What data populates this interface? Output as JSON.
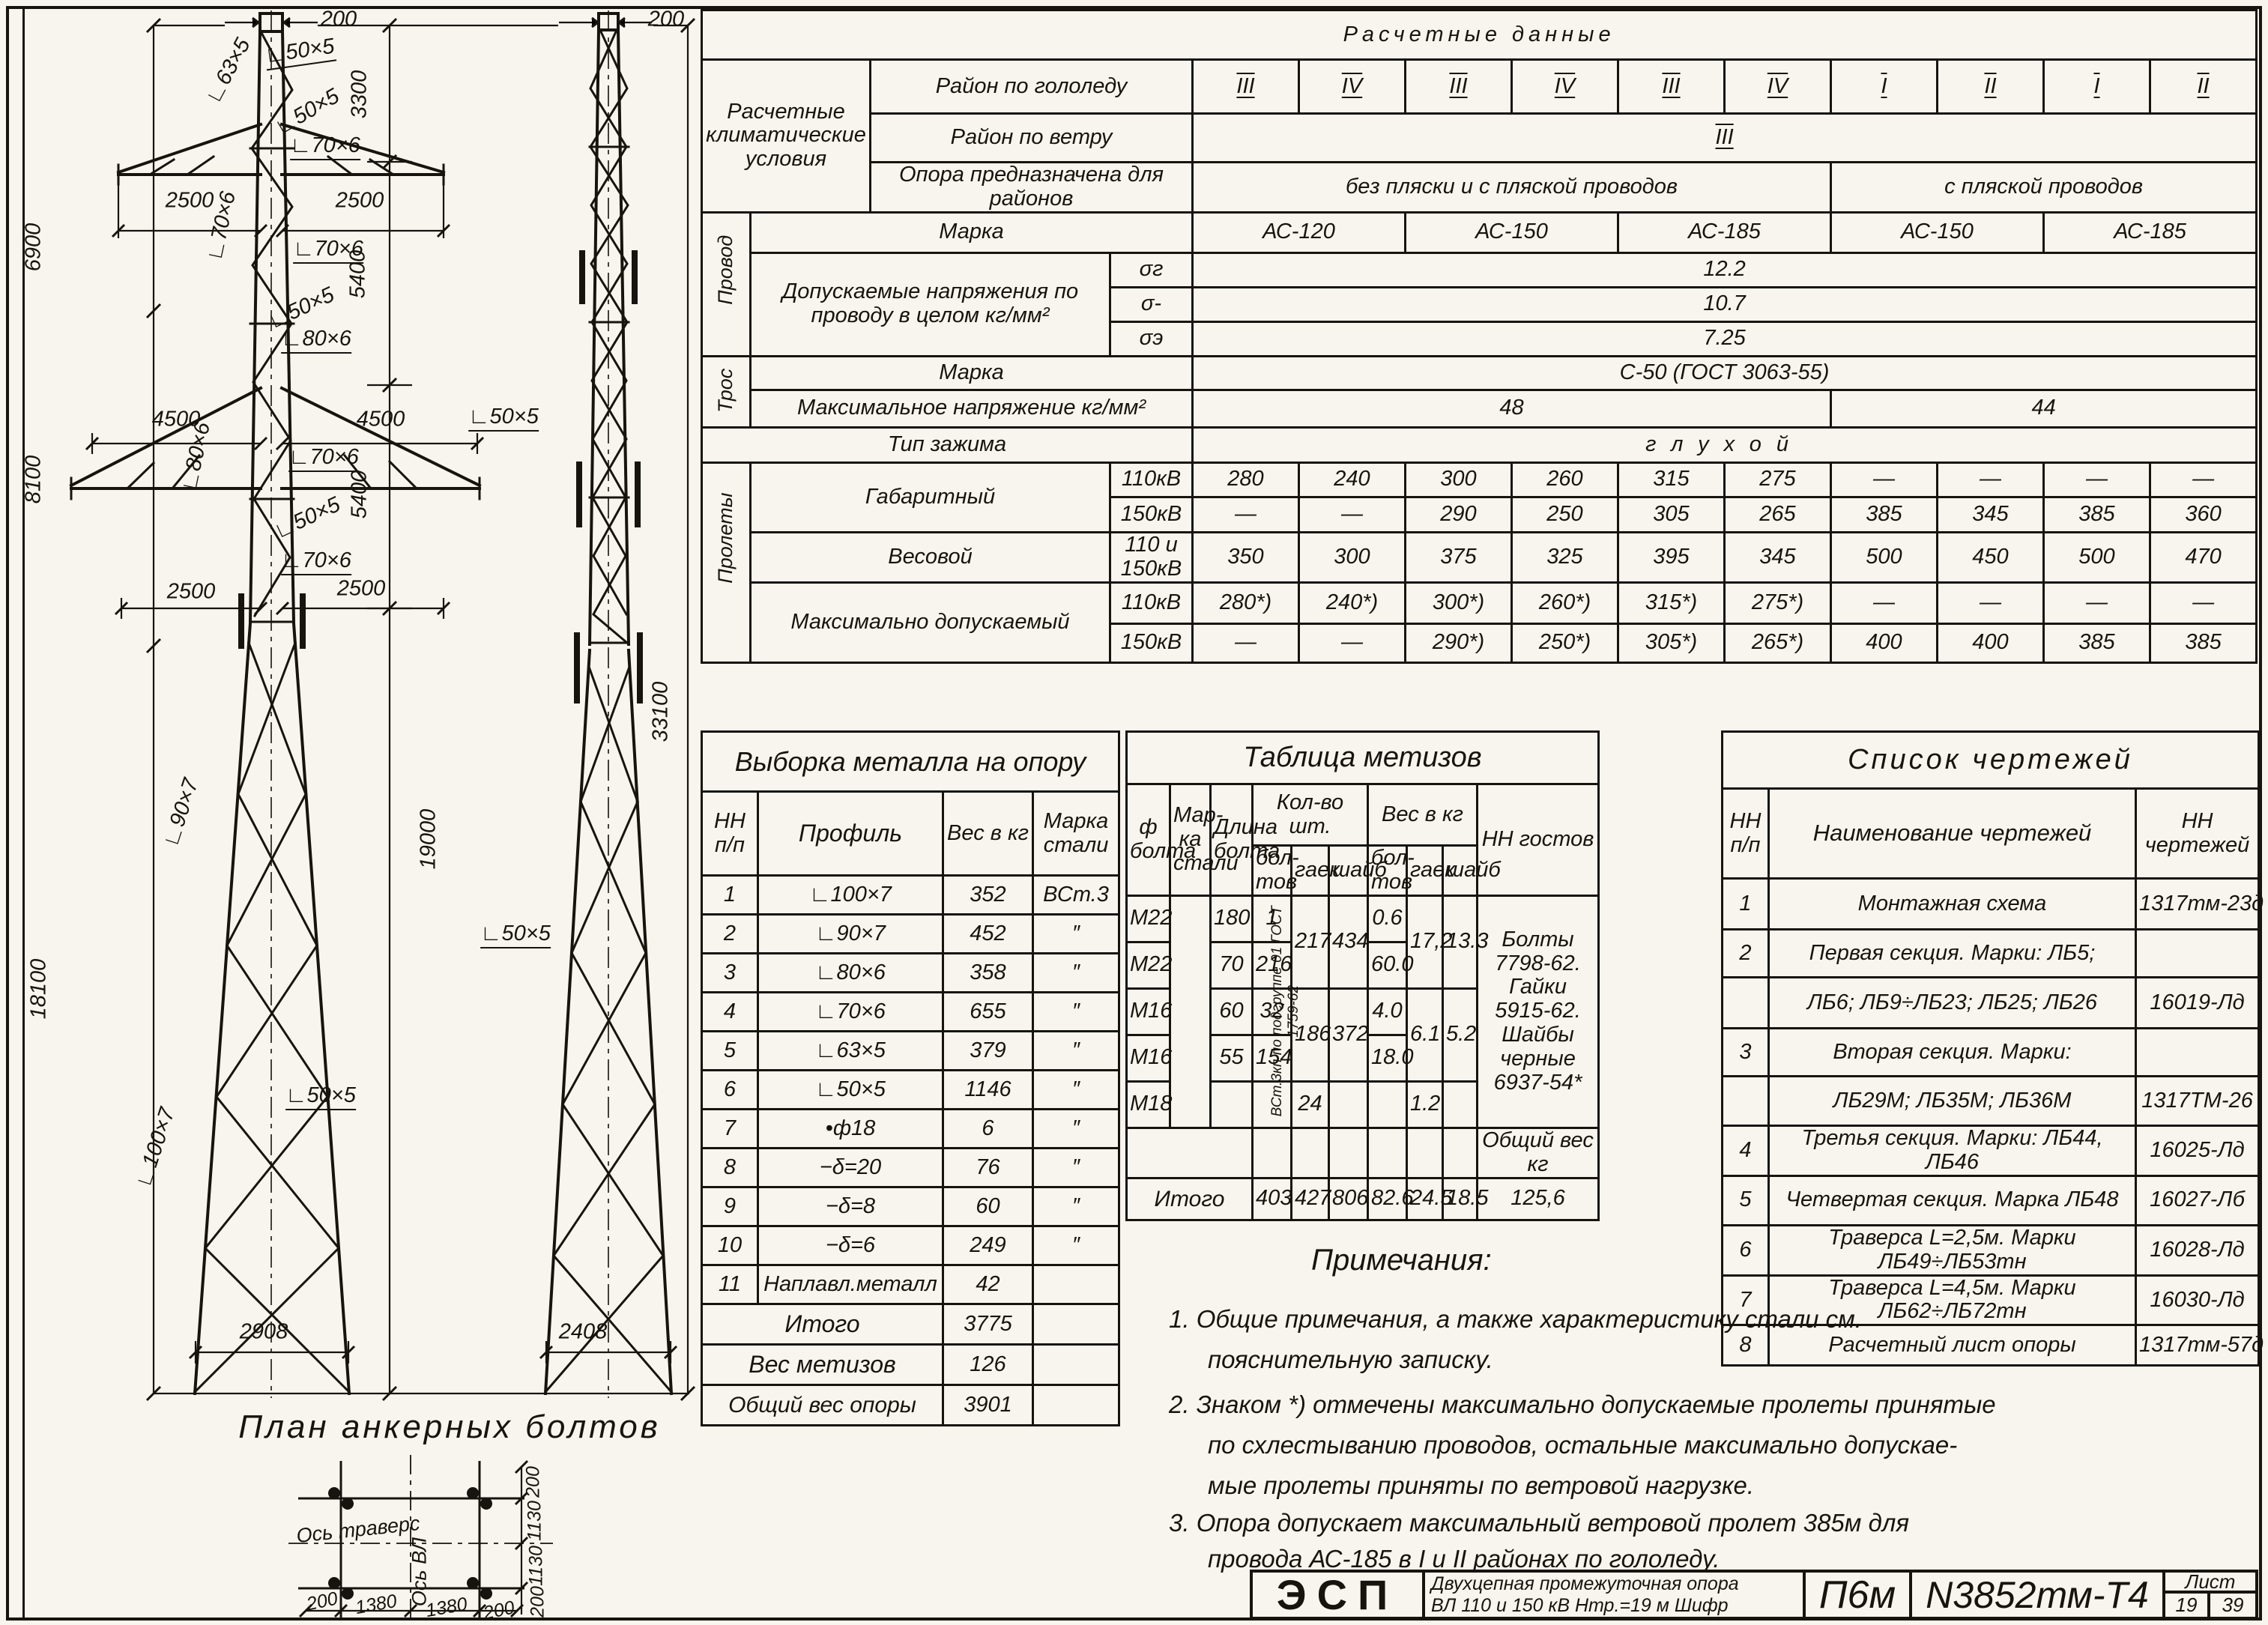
{
  "sheet": {
    "calc": {
      "title": "Расчетные  данные",
      "left_header": "Расчетные климатические условия",
      "ice_label": "Район по гололеду",
      "ice": [
        "III",
        "IV",
        "III",
        "IV",
        "III",
        "IV",
        "I",
        "II",
        "I",
        "II"
      ],
      "wind_label": "Район по ветру",
      "wind": "III",
      "purpose_label": "Опора предназначена для районов",
      "purpose_a": "без пляски и с пляской проводов",
      "purpose_b": "с пляской проводов",
      "wire_side": "Провод",
      "wire_marka_label": "Марка",
      "wire_marka": [
        "АС-120",
        "АС-150",
        "АС-185",
        "АС-150",
        "АС-185"
      ],
      "stress_label": "Допускаемые напряжения по проводу в целом кг/мм²",
      "s1_label": "σг",
      "s1": "12.2",
      "s2_label": "σ-",
      "s2": "10.7",
      "s3_label": "σэ",
      "s3": "7.25",
      "cable_side": "Трос",
      "cable_marka_label": "Марка",
      "cable_marka": "С-50 (ГОСТ 3063-55)",
      "tension_label": "Максимальное напряжение кг/мм²",
      "tension_a": "48",
      "tension_b": "44",
      "clamp_label": "Тип зажима",
      "clamp": "глухой",
      "spans_side": "Пролеты",
      "gabarit_label": "Габаритный",
      "kv110": "110кВ",
      "kv150": "150кВ",
      "kv_both": "110 и 150кВ",
      "g110": [
        "280",
        "240",
        "300",
        "260",
        "315",
        "275",
        "—",
        "—",
        "—",
        "—"
      ],
      "g150": [
        "—",
        "—",
        "290",
        "250",
        "305",
        "265",
        "385",
        "345",
        "385",
        "360"
      ],
      "weight_label": "Весовой",
      "wv": [
        "350",
        "300",
        "375",
        "325",
        "395",
        "345",
        "500",
        "450",
        "500",
        "470"
      ],
      "max_label": "Максимально допускаемый",
      "m110": [
        "280*)",
        "240*)",
        "300*)",
        "260*)",
        "315*)",
        "275*)",
        "—",
        "—",
        "—",
        "—"
      ],
      "m150": [
        "—",
        "—",
        "290*)",
        "250*)",
        "305*)",
        "265*)",
        "400",
        "400",
        "385",
        "385"
      ]
    },
    "metal": {
      "title": "Выборка металла на опору",
      "h_nn": "НН п/п",
      "h_profile": "Профиль",
      "h_weight": "Вес в кг",
      "h_steel": "Марка стали",
      "rows": [
        [
          "1",
          "∟100×7",
          "352",
          "ВСт.3"
        ],
        [
          "2",
          "∟90×7",
          "452",
          "″"
        ],
        [
          "3",
          "∟80×6",
          "358",
          "″"
        ],
        [
          "4",
          "∟70×6",
          "655",
          "″"
        ],
        [
          "5",
          "∟63×5",
          "379",
          "″"
        ],
        [
          "6",
          "∟50×5",
          "1146",
          "″"
        ],
        [
          "7",
          "•ф18",
          "6",
          "″"
        ],
        [
          "8",
          "−δ=20",
          "76",
          "″"
        ],
        [
          "9",
          "−δ=8",
          "60",
          "″"
        ],
        [
          "10",
          "−δ=6",
          "249",
          "″"
        ],
        [
          "11",
          "Наплавл.металл",
          "42",
          ""
        ]
      ],
      "total_label": "Итого",
      "total": "3775",
      "hw_label": "Вес метизов",
      "hw": "126",
      "grand_label": "Общий вес опоры",
      "grand": "3901"
    },
    "hardware": {
      "title": "Таблица метизов",
      "h_dia": "ф болта",
      "h_steel": "Мар-ка стали",
      "h_len": "Длина болта",
      "h_qty": "Кол-во шт.",
      "h_wt": "Вес в кг",
      "h_gost": "НН гостов",
      "h_bolts": "бол-тов",
      "h_nuts": "гаек",
      "h_wash": "шайб",
      "steel_note": "ВСт.3кп по подгруппе 01 ГОСТ 1759-62",
      "gost_note": "Болты 7798-62. Гайки 5915-62. Шайбы черные 6937-54*",
      "total_wt_label": "Общий вес кг",
      "r1": [
        "М22",
        "180",
        "1",
        "0.6"
      ],
      "r2": [
        "М22",
        "70",
        "216",
        "60.0"
      ],
      "r3": [
        "М16",
        "60",
        "32",
        "4.0"
      ],
      "r4": [
        "М16",
        "55",
        "154",
        "18.0"
      ],
      "r5": [
        "М18",
        "",
        "24",
        "1.2"
      ],
      "qn12": "217",
      "qw12": "434",
      "wn12": "17,2",
      "ww12": "13.3",
      "qn34": "186",
      "qw34": "372",
      "wn34": "6.1",
      "ww34": "5.2",
      "total_label": "Итого",
      "totals": [
        "403",
        "427",
        "806",
        "82.6",
        "24.5",
        "18.5",
        "125,6"
      ]
    },
    "list": {
      "title": "Список чертежей",
      "h_nn": "НН п/п",
      "h_name": "Наименование чертежей",
      "h_num": "НН чертежей",
      "rows": [
        [
          "1",
          "Монтажная схема",
          "1317тм-23д"
        ],
        [
          "2",
          "Первая секция. Марки: ЛБ5;",
          ""
        ],
        [
          "",
          "ЛБ6; ЛБ9÷ЛБ23; ЛБ25; ЛБ26",
          "16019-Лд"
        ],
        [
          "3",
          "Вторая секция. Марки:",
          ""
        ],
        [
          "",
          "ЛБ29М; ЛБ35М; ЛБ36М",
          "1317ТМ-26"
        ],
        [
          "4",
          "Третья секция. Марки: ЛБ44, ЛБ46",
          "16025-Лд"
        ],
        [
          "5",
          "Четвертая секция. Марка ЛБ48",
          "16027-Лб"
        ],
        [
          "6",
          "Траверса L=2,5м. Марки ЛБ49÷ЛБ53тн",
          "16028-Лд"
        ],
        [
          "7",
          "Траверса L=4,5м. Марки ЛБ62÷ЛБ72тн",
          "16030-Лд"
        ],
        [
          "8",
          "Расчетный лист опоры",
          "1317тм-57д"
        ]
      ]
    },
    "notes": {
      "title": "Примечания:",
      "n1a": "1. Общие примечания, а также характеристику стали см.",
      "n1b": "пояснительную записку.",
      "n2a": "2. Знаком *) отмечены максимально допускаемые пролеты принятые",
      "n2b": "по схлестыванию проводов, остальные максимально допускае-",
      "n2c": "мые пролеты приняты  по ветровой нагрузке.",
      "n3a": "3. Опора допускает максимальный ветровой пролет 385м для",
      "n3b": "провода АС-185 в I и II районах по гололеду."
    },
    "tb": {
      "org": "ЭСП",
      "desc1": "Двухцепная промежуточная опора",
      "desc2": "ВЛ 110 и 150 кВ  Нтр.=19 м        Шифр",
      "type": "П6м",
      "num": "N3852тм-Т4",
      "sheet_label": "Лист",
      "sheet_no": "19",
      "sheet_total": "39"
    },
    "dwg": {
      "front_top": "200",
      "side_top": "200",
      "h1": "6900",
      "h2": "8100",
      "h3": "18100",
      "v1": "3300",
      "v2": "5400",
      "v3": "5400",
      "v4": "19000",
      "vtotal": "33100",
      "a1l": "2500",
      "a1r": "2500",
      "a2l": "4500",
      "a2r": "4500",
      "a3l": "2500",
      "a3r": "2500",
      "base_front": "2908",
      "base_side": "2408",
      "m1": "∟63×5",
      "m2": "∟50×5",
      "m3": "∟50×5",
      "m4": "∟70×6",
      "m5": "∟70×6",
      "m6": "∟70×6",
      "m7": "∟50×5",
      "m8": "∟80×6",
      "m9": "∟80×6",
      "m10": "∟70×6",
      "m11": "∟50×5",
      "m12": "∟70×6",
      "m13": "∟90×7",
      "m14": "∟50×5",
      "m15": "∟100×7",
      "m16": "∟50×5",
      "m17": "∟50×5",
      "plan_title": "План анкерных болтов",
      "axis_trav": "Ось траверс",
      "axis_vl": "Ось ВЛ",
      "pr1": "200",
      "pr2": "1130",
      "pr3": "1130",
      "pr4": "200",
      "pb1": "200",
      "pb2": "1380",
      "pb3": "1380",
      "pb4": "200"
    }
  }
}
